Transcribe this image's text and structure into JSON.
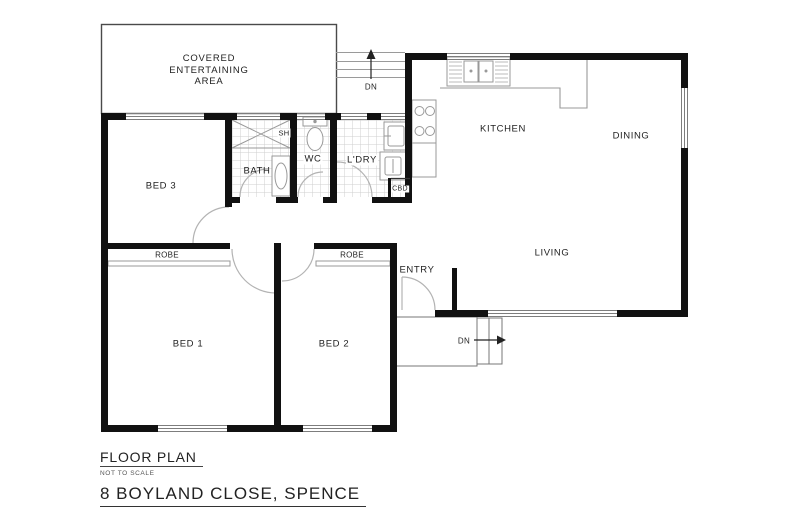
{
  "title_block": {
    "plan_title": "FLOOR PLAN",
    "scale_note": "NOT TO SCALE",
    "address": "8 BOYLAND CLOSE, SPENCE"
  },
  "rooms": {
    "covered_area": [
      "COVERED",
      "ENTERTAINING",
      "AREA"
    ],
    "bed3": "BED 3",
    "bed1": "BED 1",
    "bed2": "BED 2",
    "robe1": "ROBE",
    "robe2": "ROBE",
    "bath": "BATH",
    "shower": "SH",
    "wc": "WC",
    "laundry": "L'DRY",
    "cupboard": "CBD",
    "kitchen": "KITCHEN",
    "dining": "DINING",
    "living": "LIVING",
    "entry": "ENTRY"
  },
  "annotations": {
    "stairs_top": "DN",
    "stairs_entry": "DN"
  },
  "colors": {
    "wall": "#111111",
    "fixture_line": "#999999",
    "tile_line": "#cfcfcf",
    "door_swing": "#b0b0b0",
    "text": "#1f1f1f",
    "background": "#ffffff"
  }
}
